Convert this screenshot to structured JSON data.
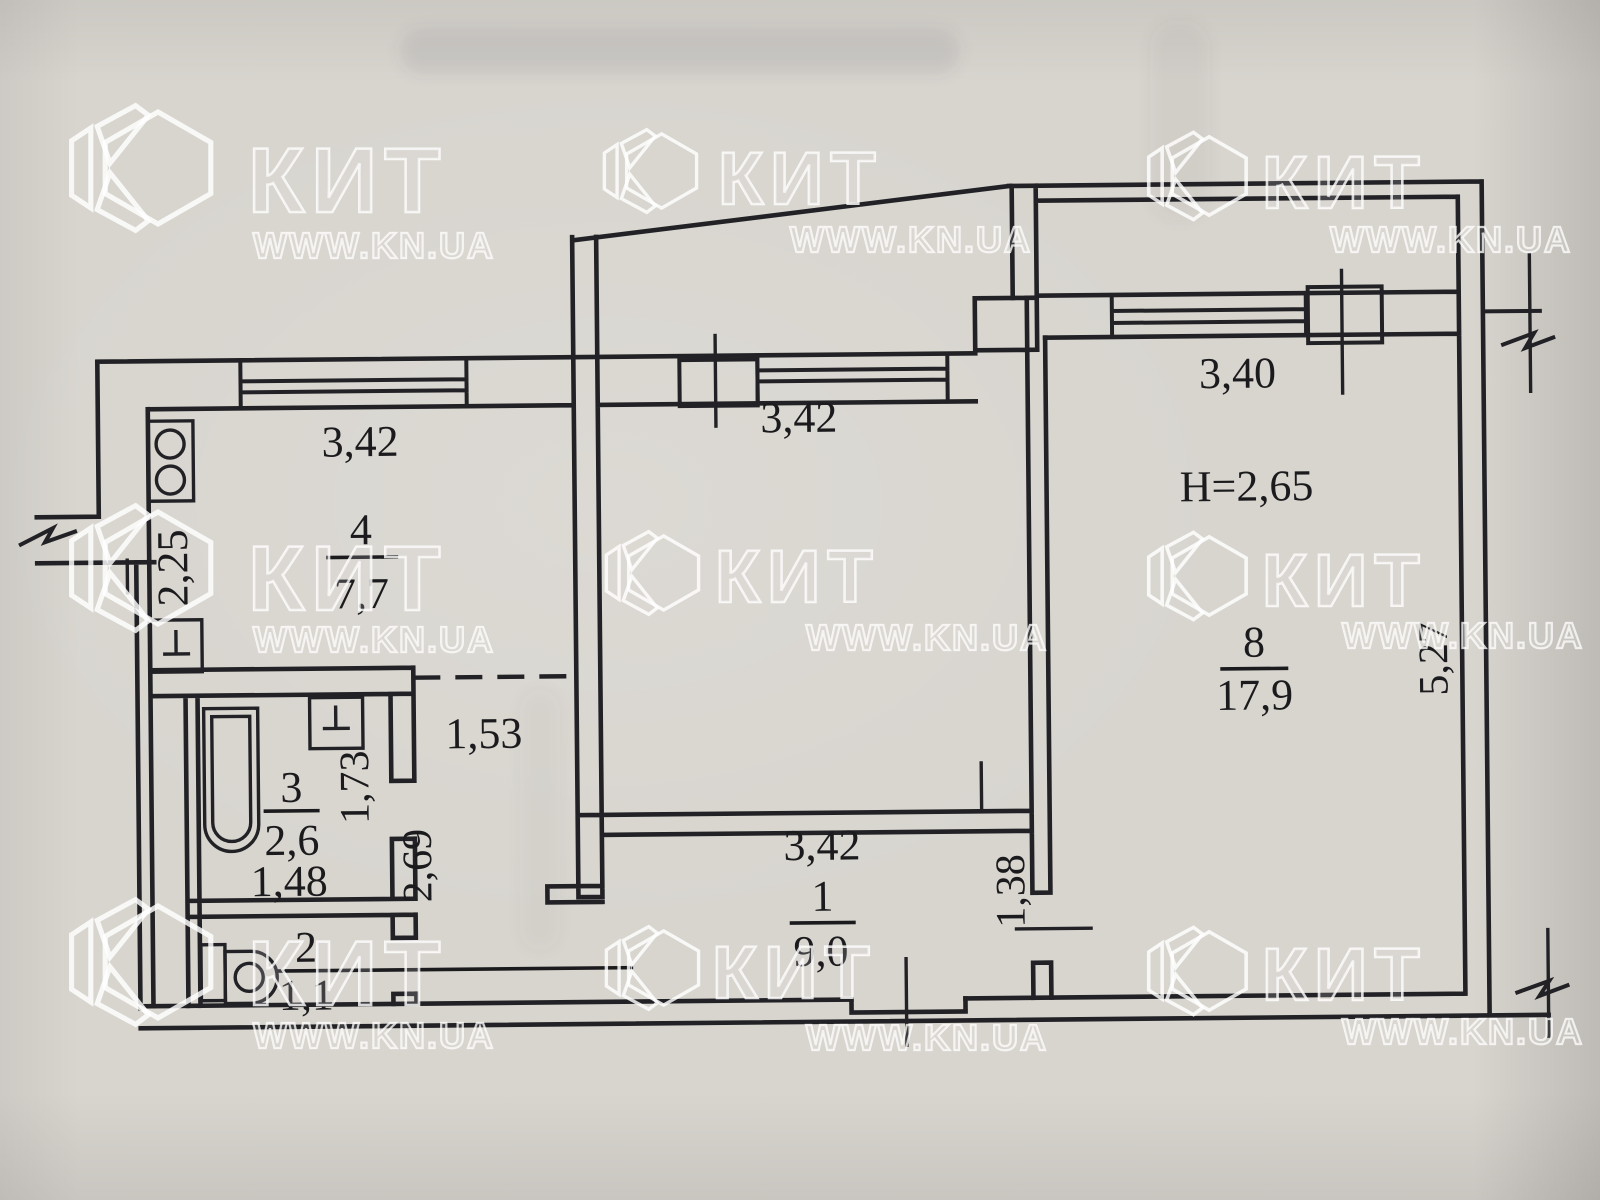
{
  "watermark": {
    "brand": "КИТ",
    "url": "WWW.KN.UA"
  },
  "plan": {
    "ceiling_height": "H=2,65",
    "rooms": {
      "hall": {
        "number": "1",
        "area": "9,0"
      },
      "wc": {
        "number": "2",
        "area": "1,1"
      },
      "bathroom": {
        "number": "3",
        "area": "2,6"
      },
      "kitchen": {
        "number": "4",
        "area": "7,7"
      },
      "living_room": {
        "number": "8",
        "area": "17,9"
      }
    },
    "dims": {
      "kitchen_width": "3,42",
      "kitchen_depth": "2,25",
      "center_room_width": "3,42",
      "hall_width": "3,42",
      "loggia_width": "3,40",
      "corridor_width": "1,53",
      "bathroom_width": "1,48",
      "bathroom_depth": "1,73",
      "corridor_depth": "2,69",
      "niche_depth": "1,38",
      "living_depth": "5,27"
    }
  },
  "colors": {
    "paper": "#d8d5cf",
    "ink": "#222226",
    "watermark": "#ffffff"
  }
}
